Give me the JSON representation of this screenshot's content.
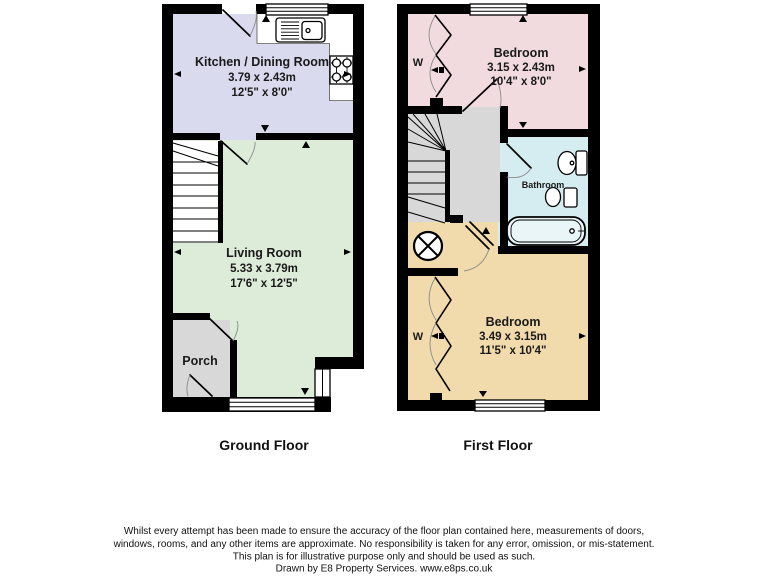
{
  "page": {
    "background": "#ffffff",
    "wall_color": "#000000"
  },
  "ground_floor": {
    "label": "Ground Floor",
    "kitchen": {
      "name": "Kitchen / Dining Room",
      "metric": "3.79 x 2.43m",
      "imperial": "12'5\" x 8'0\"",
      "color": "#dadaee"
    },
    "living": {
      "name": "Living Room",
      "metric": "5.33 x 3.79m",
      "imperial": "17'6\" x 12'5\"",
      "color": "#dcecd9"
    },
    "porch": {
      "name": "Porch",
      "color": "#d8d8d8"
    }
  },
  "first_floor": {
    "label": "First Floor",
    "bedroom1": {
      "name": "Bedroom",
      "metric": "3.15 x 2.43m",
      "imperial": "10'4\" x 8'0\"",
      "color": "#f2dbdf",
      "wardrobe": "W"
    },
    "bathroom": {
      "name": "Bathroom",
      "color": "#d5edf0",
      "tub_color": "#e9f5f7"
    },
    "bedroom2": {
      "name": "Bedroom",
      "metric": "3.49 x 3.15m",
      "imperial": "11'5\" x 10'4\"",
      "color": "#f1dbac",
      "wardrobe": "W"
    },
    "landing_color": "#d8d8d8"
  },
  "footer": {
    "disclaimer_line1": "Whilst every attempt has been made to ensure the accuracy of the floor plan contained here, measurements of doors,",
    "disclaimer_line2": "windows, rooms, and any other items are approximate. No responsibility is taken for any error, omission, or mis-statement.",
    "disclaimer_line3": "This plan is for illustrative purpose only and should be used as such.",
    "disclaimer_line4": "Drawn by E8 Property Services. www.e8ps.co.uk"
  }
}
